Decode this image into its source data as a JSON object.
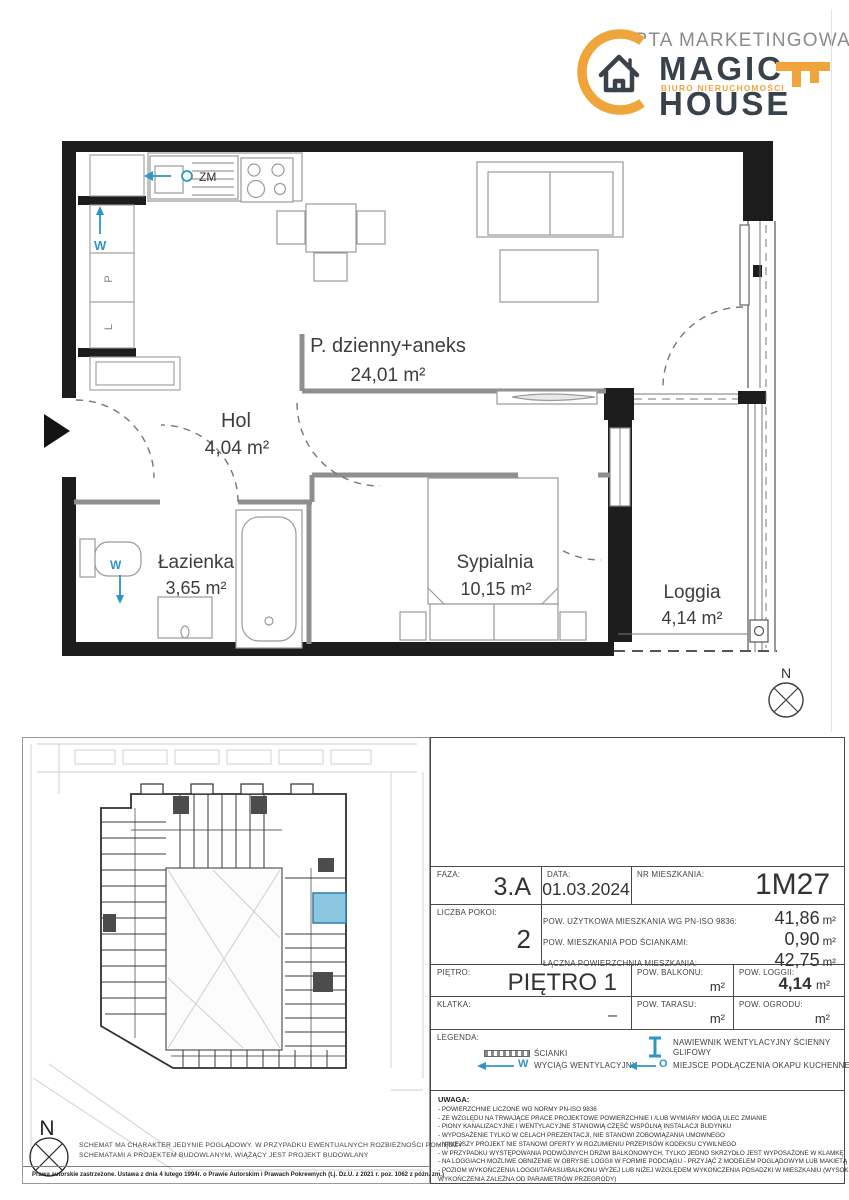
{
  "header": {
    "watermark": "KARTA MARKETINGOWA",
    "logo": {
      "name_top": "MAGIC",
      "name_bottom": "HOUSE",
      "tagline": "BIURO NIERUCHOMOŚCI"
    }
  },
  "floorplan": {
    "rooms": [
      {
        "name": "P. dzienny+aneks",
        "area": "24,01 m²"
      },
      {
        "name": "Hol",
        "area": "4,04 m²"
      },
      {
        "name": "Łazienka",
        "area": "3,65 m²"
      },
      {
        "name": "Sypialnia",
        "area": "10,15 m²"
      },
      {
        "name": "Loggia",
        "area": "4,14 m²"
      }
    ],
    "markers": {
      "sink": "ZM",
      "vent": "W",
      "closet_top": "P",
      "closet_bottom": "L",
      "wc_vent": "W"
    },
    "compass": "N"
  },
  "siteplan": {
    "compass": "N"
  },
  "footer": {
    "disclaimer_line1": "SCHEMAT MA CHARAKTER JEDYNIE POGLĄDOWY. W PRZYPADKU EWENTUALNYCH ROZBIEŻNOŚCI POMIĘDZY",
    "disclaimer_line2": "SCHEMATAMI A PROJEKTEM BUDOWLANYM, WIĄŻĄCY JEST PROJEKT BUDOWLANY",
    "copyright": "Prawa autorskie zastrzeżone. Ustawa z dnia 4 lutego 1994r. o Prawie Autorskim i Prawach Pokrewnych (t.j. Dz.U. z 2021 r. poz. 1062 z późn. zm.)"
  },
  "info": {
    "faza": {
      "label": "FAZA:",
      "value": "3.A"
    },
    "data": {
      "label": "DATA:",
      "value": "01.03.2024"
    },
    "nr_mieszkania": {
      "label": "NR MIESZKANIA:",
      "value": "1M27"
    },
    "liczba_pokoi": {
      "label": "LICZBA POKOI:",
      "value": "2"
    },
    "areas": [
      {
        "label": "POW. UŻYTKOWA MIESZKANIA WG PN-ISO 9836:",
        "value": "41,86",
        "unit": "m²"
      },
      {
        "label": "POW. MIESZKANIA POD ŚCIANKAMI:",
        "value": "0,90",
        "unit": "m²"
      },
      {
        "label": "ŁĄCZNA POWIERZCHNIA MIESZKANIA:",
        "value": "42,75",
        "unit": "m²"
      }
    ],
    "pietro": {
      "label": "PIĘTRO:",
      "value": "PIĘTRO 1"
    },
    "balkon": {
      "label": "POW. BALKONU:",
      "value": "",
      "unit": "m²"
    },
    "loggia": {
      "label": "POW. LOGGII:",
      "value": "4,14",
      "unit": "m²"
    },
    "klatka": {
      "label": "KLATKA:",
      "value": "–"
    },
    "taras": {
      "label": "POW. TARASU:",
      "value": "",
      "unit": "m²"
    },
    "ogrod": {
      "label": "POW. OGRODU:",
      "value": "",
      "unit": "m²"
    }
  },
  "legend": {
    "title": "LEGENDA:",
    "walls_label": "ŚCIANKI",
    "vent_symbol": "W",
    "vent_label": "WYCIĄG WENTYLACYJNY",
    "diffuser_label_line1": "NAWIEWNIK WENTYLACYJNY ŚCIENNY",
    "diffuser_label_line2": "GLIFOWY",
    "hood_symbol": "O",
    "hood_label": "MIEJSCE PODŁĄCZENIA OKAPU KUCHENNEGO"
  },
  "notes": {
    "title": "UWAGA:",
    "lines": [
      "- POWIERZCHNIE LICZONE WG NORMY PN-ISO 9836",
      "- ZE WZGLĘDU NA TRWAJĄCE PRACE PROJEKTOWE POWIERZCHNIE I /LUB WYMIARY MOGĄ ULEC ZMIANIE",
      "- PIONY KANALIZACYJNE I WENTYLACYJNE STANOWIĄ CZĘŚĆ WSPÓLNĄ INSTALACJI BUDYNKU",
      "- WYPOSAŻENIE TYLKO W CELACH PREZENTACJI, NIE STANOWI ZOBOWIĄZANIA UMOWNEGO",
      "- NINIEJSZY PROJEKT NIE STANOWI OFERTY W ROZUMIENIU PRZEPISÓW KODEKSU CYWILNEGO",
      "- W PRZYPADKU WYSTĘPOWANIA PODWÓJNYCH DRZWI BALKONOWYCH, TYLKO JEDNO SKRZYDŁO JEST WYPOSAŻONE W KLAMKĘ",
      "- NA LOGGIACH MOŻLIWE OBNIŻENIE W OBRYSIE LOGGII W FORMIE PODCIĄGU - PRZYJĄĆ Z MODELEM POGLĄDOWYM LUB MAKIETĄ",
      "- POZIOM WYKOŃCZENIA LOGGII/TARASU/BALKONU WYŻEJ LUB NIŻEJ WZGLĘDEM WYKOŃCZENIA POSADZKI W MIESZKANIU (WYSOKOŚĆ",
      "WYKOŃCZENIA ZALEŻNA OD PARAMETRÓW PRZEGRODY)"
    ]
  },
  "colors": {
    "accent_orange": "#F0A43C",
    "accent_blue": "#2E96C7",
    "wall_black": "#1D1D1D",
    "highlight_fill": "#8CC7E2",
    "highlight_stroke": "#2E7FAC"
  }
}
